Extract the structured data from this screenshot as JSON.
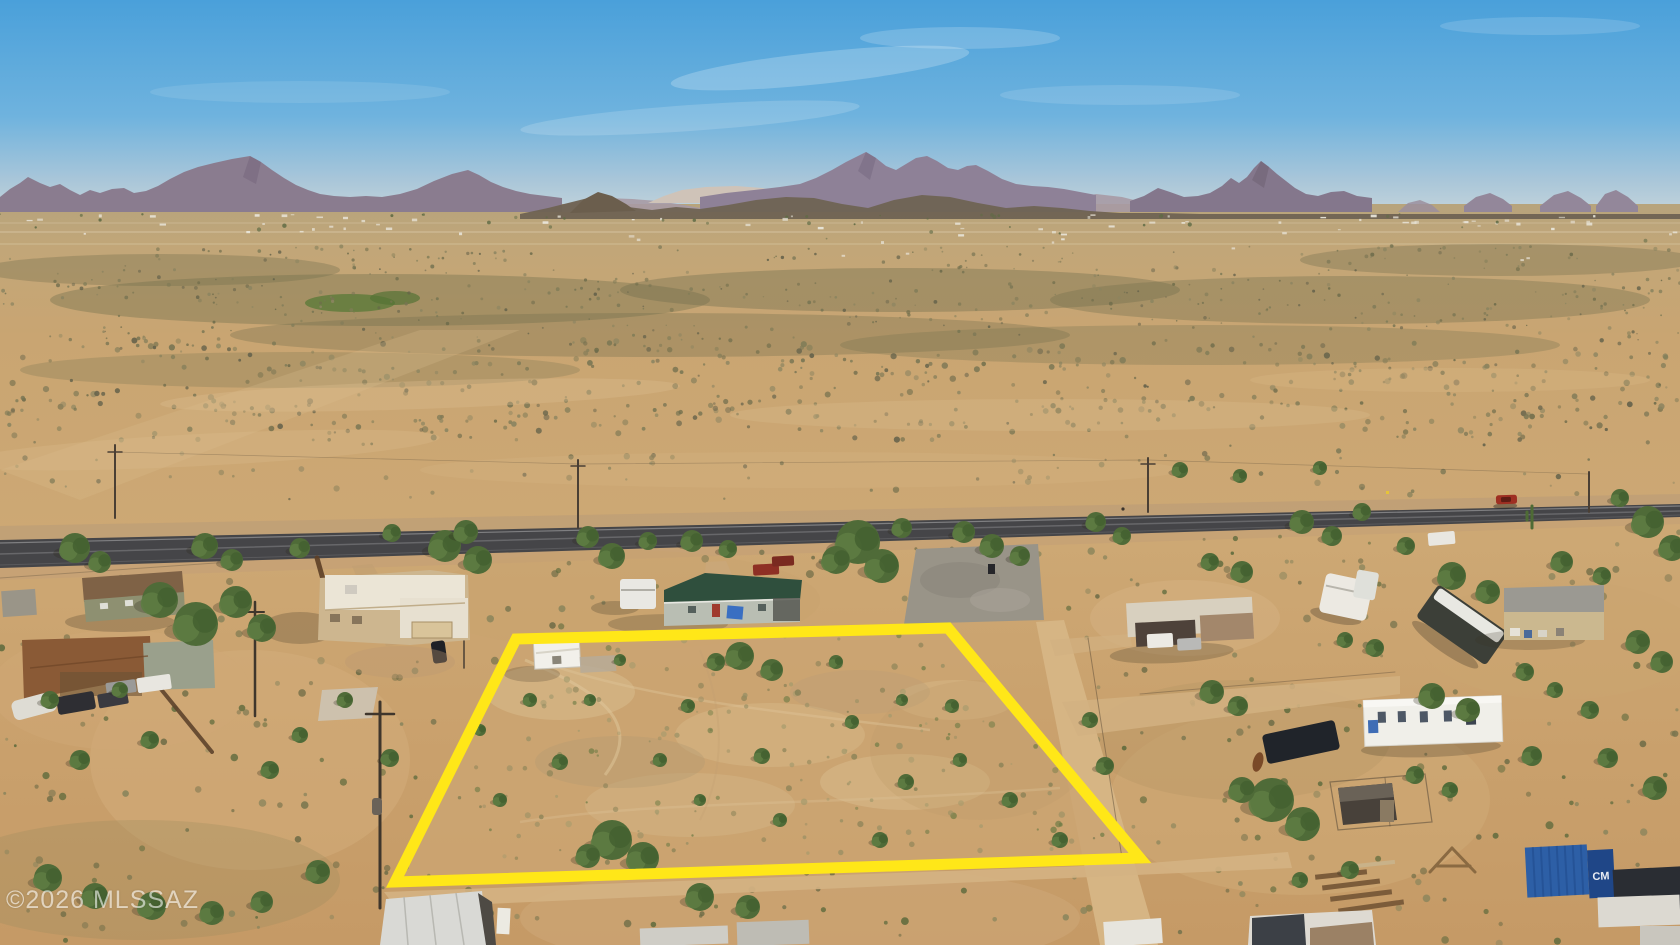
{
  "meta": {
    "image_type": "aerial drone photograph",
    "subject": "vacant desert land parcel highlighted with a yellow boundary, rural properties and highway, mountain horizon",
    "width_px": 1680,
    "height_px": 945
  },
  "watermark": {
    "text": "©2026 MLSSAZ",
    "color": "#ffffff",
    "opacity": 0.58
  },
  "overlay": {
    "boundary_color": "#ffe718",
    "boundary_stroke_width": 11,
    "boundary_points": "516,639 948,628 1140,858 395,882"
  },
  "labels": {
    "container_label": "CM"
  },
  "palette": {
    "sky_top": "#4aa0da",
    "sky_horizon": "#c2d3da",
    "mountain": "#8a7c8f",
    "desert_far": "#c2a678",
    "desert_near": "#c79e6d",
    "scrub_green": "#6f6d4c",
    "road_asphalt": "#454548",
    "lot_ground": "#cba572",
    "boundary_yellow": "#ffe718"
  }
}
